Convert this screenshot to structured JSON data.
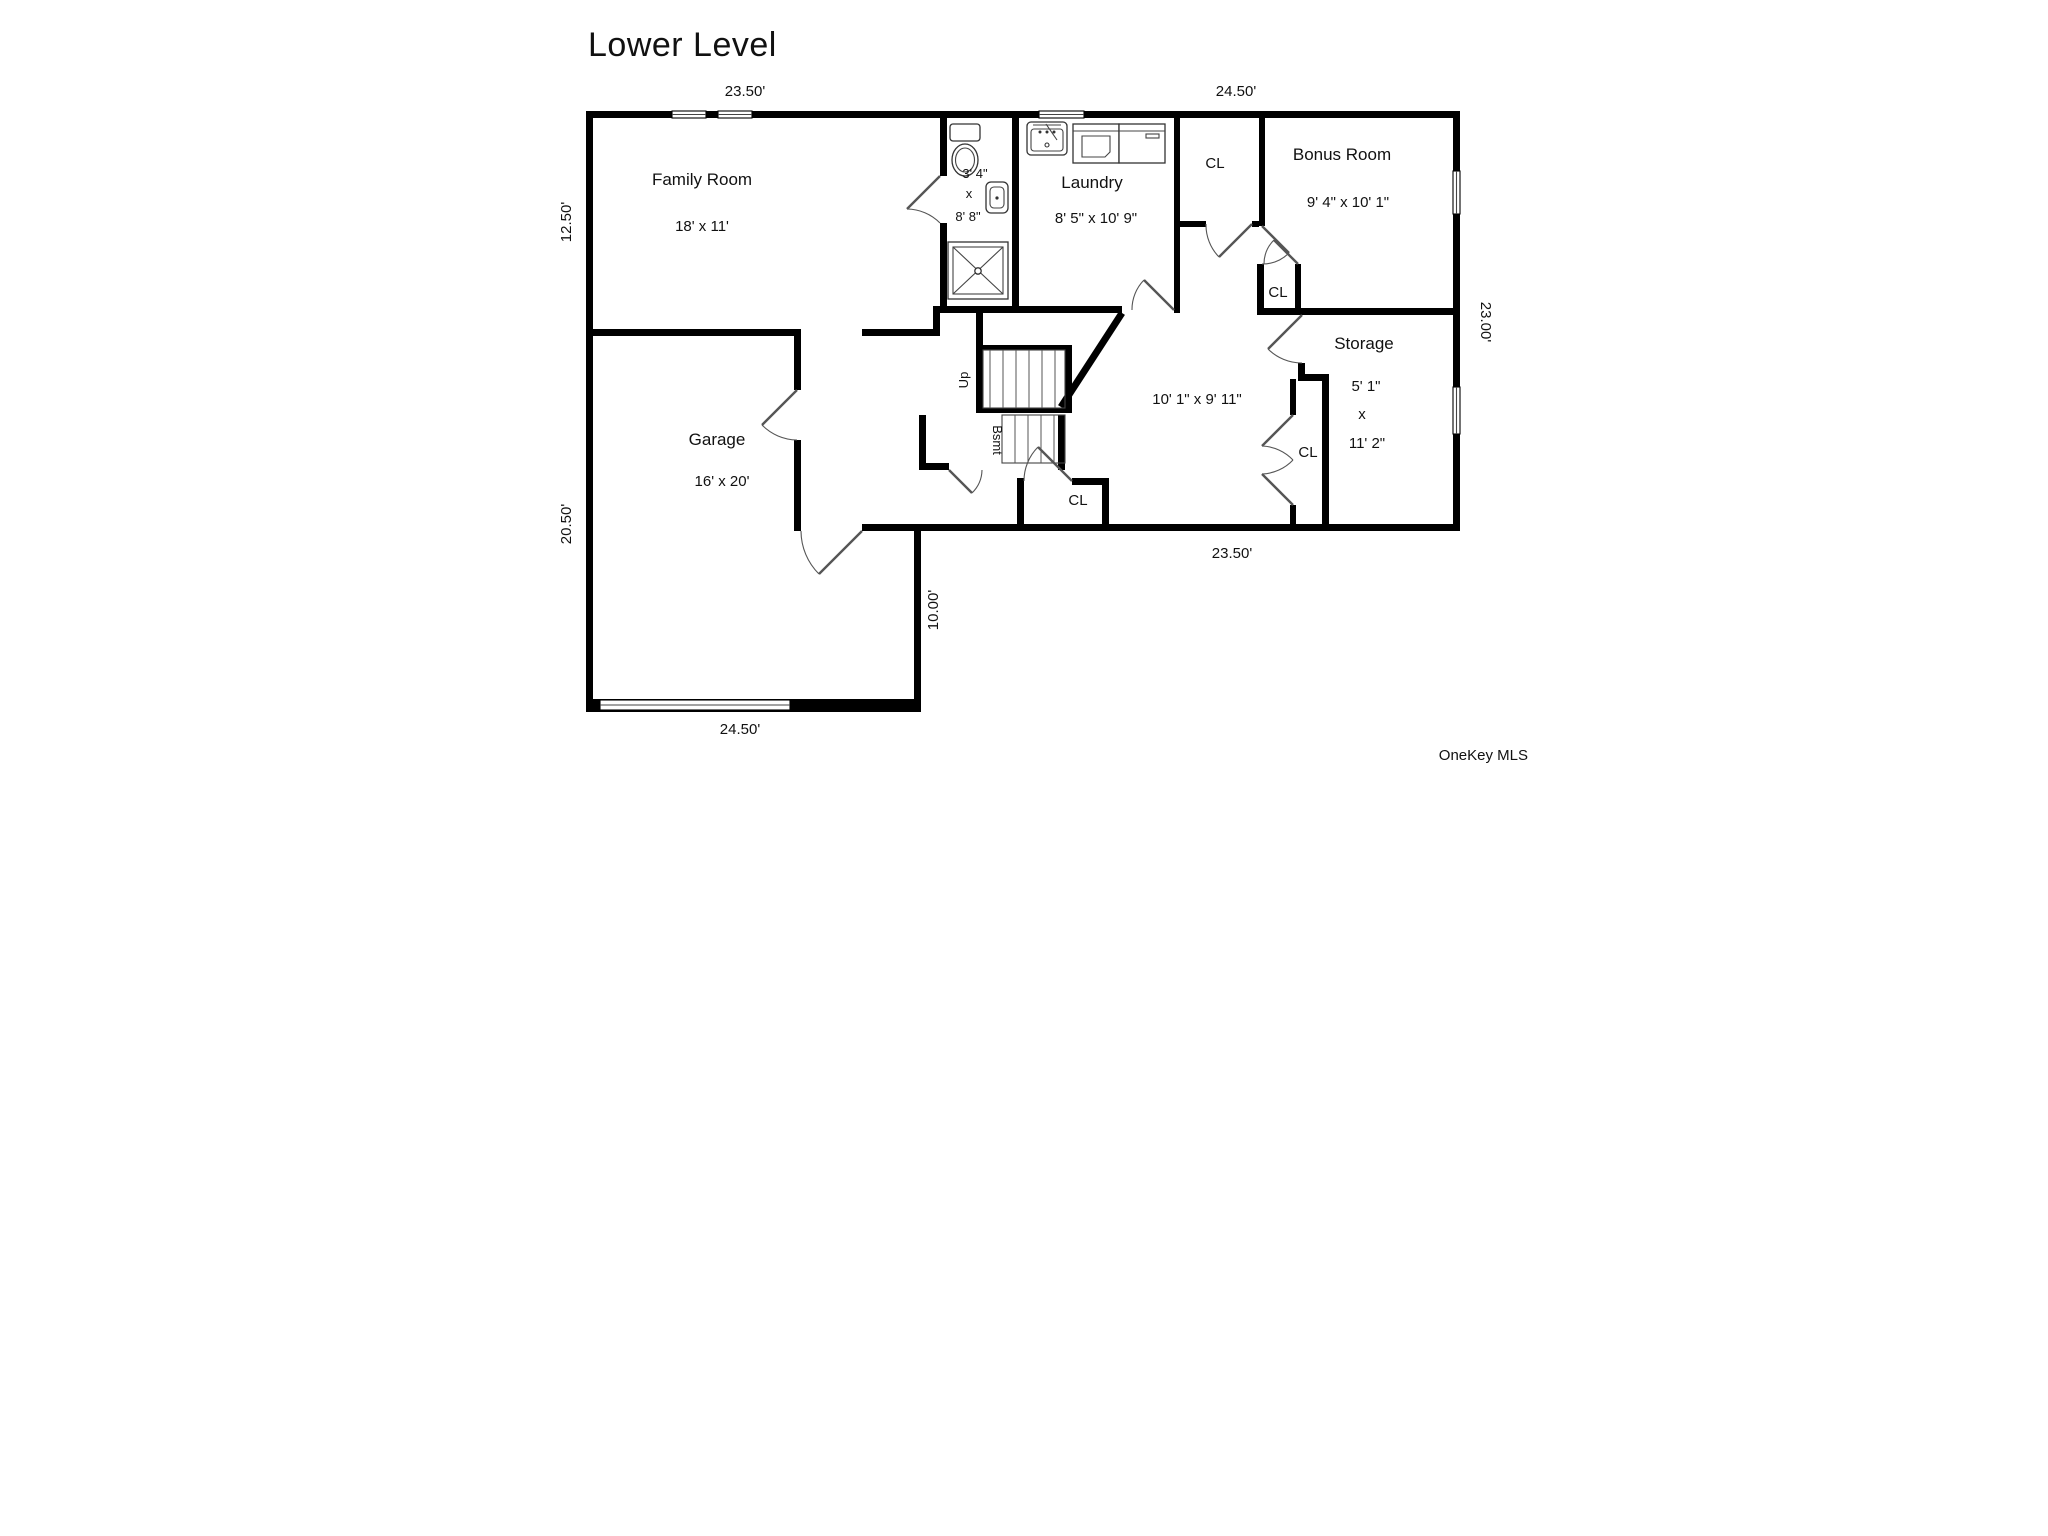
{
  "title": "Lower Level",
  "watermark": "OneKey MLS",
  "floor_plan": {
    "rooms": [
      {
        "name": "Family Room",
        "dimensions": "18' x 11'"
      },
      {
        "name": "Bathroom",
        "dimensions": "3' 4\" x 8' 8\""
      },
      {
        "name": "Laundry",
        "dimensions": "8' 5\" x 10' 9\""
      },
      {
        "name": "Bonus Room",
        "dimensions": "9' 4\" x 10' 1\""
      },
      {
        "name": "Storage",
        "dimensions": "5' 1\" x 11' 2\""
      },
      {
        "name": "Hall",
        "dimensions": "10' 1\" x 9' 11\""
      },
      {
        "name": "Garage",
        "dimensions": "16' x 20'"
      }
    ],
    "closet_label": "CL",
    "stairs": [
      {
        "label": "Up"
      },
      {
        "label": "Bsmt"
      }
    ],
    "exterior_dimensions": [
      "23.50'",
      "24.50'",
      "12.50'",
      "20.50'",
      "23.00'",
      "23.50'",
      "10.00'",
      "24.50'"
    ]
  },
  "labels": [
    {
      "id": "title",
      "text": "Lower Level"
    },
    {
      "id": "dim-top-left",
      "text": "23.50'"
    },
    {
      "id": "dim-top-right",
      "text": "24.50'"
    },
    {
      "id": "dim-left-upper",
      "text": "12.50'"
    },
    {
      "id": "dim-left-lower",
      "text": "20.50'"
    },
    {
      "id": "dim-right",
      "text": "23.00'"
    },
    {
      "id": "dim-bottom-right",
      "text": "23.50'"
    },
    {
      "id": "dim-bottom-left",
      "text": "24.50'"
    },
    {
      "id": "dim-vertical-10",
      "text": "10.00'"
    },
    {
      "id": "family-room-name",
      "text": "Family Room"
    },
    {
      "id": "family-room-dims",
      "text": "18' x 11'"
    },
    {
      "id": "bath-dim-1",
      "text": "3' 4\""
    },
    {
      "id": "bath-dim-x",
      "text": "x"
    },
    {
      "id": "bath-dim-2",
      "text": "8' 8\""
    },
    {
      "id": "laundry-name",
      "text": "Laundry"
    },
    {
      "id": "laundry-dims",
      "text": "8' 5\" x 10' 9\""
    },
    {
      "id": "cl-top",
      "text": "CL"
    },
    {
      "id": "bonus-name",
      "text": "Bonus  Room"
    },
    {
      "id": "bonus-dims",
      "text": "9' 4\" x 10' 1\""
    },
    {
      "id": "cl-small",
      "text": "CL"
    },
    {
      "id": "storage-name",
      "text": "Storage"
    },
    {
      "id": "storage-dim-1",
      "text": "5' 1\""
    },
    {
      "id": "storage-dim-x",
      "text": "x"
    },
    {
      "id": "storage-dim-2",
      "text": "11' 2\""
    },
    {
      "id": "hall-dims",
      "text": "10' 1\" x 9' 11\""
    },
    {
      "id": "cl-bottom-center",
      "text": "CL"
    },
    {
      "id": "cl-bottom-right",
      "text": "CL"
    },
    {
      "id": "garage-name",
      "text": "Garage"
    },
    {
      "id": "garage-dims",
      "text": "16' x 20'"
    },
    {
      "id": "stairs-up",
      "text": "Up"
    },
    {
      "id": "stairs-bsmt",
      "text": "Bsmt"
    },
    {
      "id": "watermark",
      "text": "OneKey MLS"
    }
  ]
}
